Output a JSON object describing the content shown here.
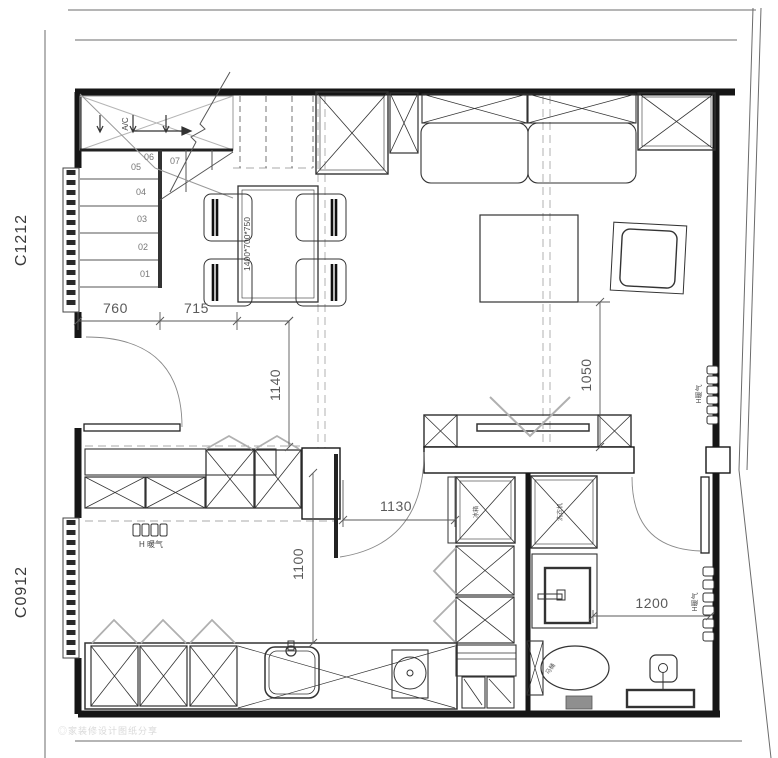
{
  "labels": {
    "window_left_upper": "C1212",
    "window_left_lower": "C0912",
    "ac_unit": "A/C",
    "dining_table_spec": "1400*700*750",
    "radiator_kitchen": "H 暖气",
    "radiator_living": "H暖气",
    "radiator_bath": "H暖气",
    "fridge": "冰箱",
    "washer": "洗衣机",
    "toilet": "马桶",
    "watermark": "◎家装修设计图纸分享"
  },
  "stair_steps": [
    "01",
    "02",
    "03",
    "04",
    "05",
    "06",
    "07"
  ],
  "dimensions": {
    "entry_width": "760",
    "dining_width": "715",
    "entry_depth": "1140",
    "living_depth": "1050",
    "corridor_width": "1130",
    "kitchen_depth": "1100",
    "bath_width": "1200"
  },
  "colors": {
    "wall": "#161616",
    "furniture": "#333333",
    "light": "#9a9a9a",
    "dim_text": "#5a5a5a"
  }
}
